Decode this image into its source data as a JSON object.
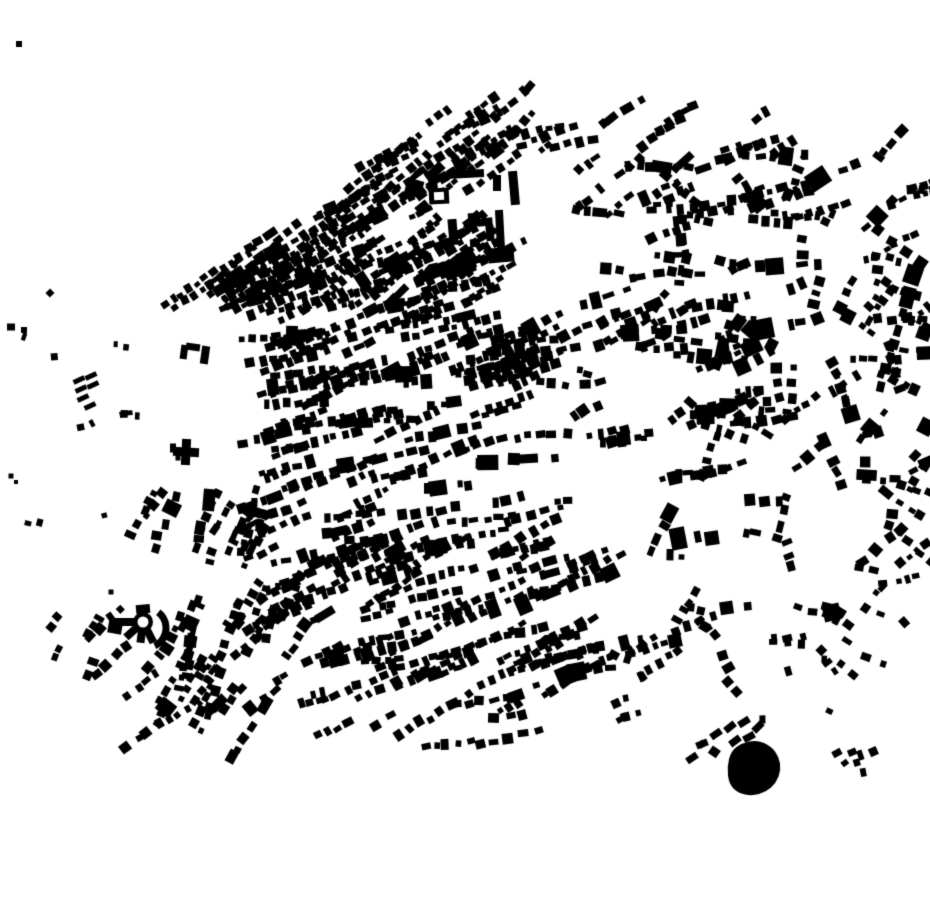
{
  "meta": {
    "map_type": "figure-ground-building-footprint-map",
    "canvas": {
      "width": 930,
      "height": 924
    }
  },
  "colors": {
    "background": "#ffffff",
    "building": "#000000"
  },
  "generation": {
    "seed": 1337,
    "regions": [
      {
        "name": "old-town-nw",
        "x": 160,
        "y": 112,
        "w": 312,
        "h": 198,
        "blocks": 100,
        "angle": -33,
        "angle_jitter": 9,
        "row_min": 3,
        "row_max": 7,
        "size_min": 4.5,
        "size_max": 10,
        "gap_min": 2,
        "gap_max": 5,
        "big_chance": 0.07,
        "rect_jitter": 7,
        "fade": "none",
        "fade_strength": 0,
        "clip_line": {
          "x1": 165,
          "y1": 298,
          "x2": 438,
          "y2": 110,
          "keep": "positive"
        },
        "avoid": []
      },
      {
        "name": "north-central",
        "x": 250,
        "y": 255,
        "w": 290,
        "h": 132,
        "blocks": 55,
        "angle": -18,
        "angle_jitter": 10,
        "row_min": 3,
        "row_max": 6,
        "size_min": 5,
        "size_max": 11,
        "gap_min": 2,
        "gap_max": 6,
        "big_chance": 0.08,
        "rect_jitter": 7,
        "fade": "none",
        "fade_strength": 0,
        "avoid": [
          {
            "x": 435,
            "y": 160,
            "w": 130,
            "h": 150
          }
        ]
      },
      {
        "name": "central-west-grid",
        "x": 225,
        "y": 335,
        "w": 292,
        "h": 228,
        "blocks": 78,
        "angle": -15,
        "angle_jitter": 12,
        "row_min": 3,
        "row_max": 6,
        "size_min": 5,
        "size_max": 11,
        "gap_min": 2,
        "gap_max": 6,
        "big_chance": 0.08,
        "rect_jitter": 7,
        "fade": "none",
        "fade_strength": 0,
        "avoid": []
      },
      {
        "name": "mid-south",
        "x": 250,
        "y": 545,
        "w": 330,
        "h": 195,
        "blocks": 56,
        "angle": -22,
        "angle_jitter": 12,
        "row_min": 3,
        "row_max": 6,
        "size_min": 5,
        "size_max": 11,
        "gap_min": 2,
        "gap_max": 6,
        "big_chance": 0.08,
        "rect_jitter": 8,
        "fade": "bottom",
        "fade_strength": 1.1,
        "avoid": []
      },
      {
        "name": "east-central",
        "x": 530,
        "y": 255,
        "w": 232,
        "h": 312,
        "blocks": 46,
        "angle": -8,
        "angle_jitter": 22,
        "row_min": 2,
        "row_max": 5,
        "size_min": 5,
        "size_max": 12,
        "gap_min": 2,
        "gap_max": 7,
        "big_chance": 0.1,
        "rect_jitter": 9,
        "fade": "none",
        "fade_strength": 0,
        "avoid": []
      },
      {
        "name": "east-scatter",
        "x": 650,
        "y": 150,
        "w": 278,
        "h": 512,
        "blocks": 62,
        "angle": 0,
        "angle_jitter": 90,
        "row_min": 2,
        "row_max": 4,
        "size_min": 5,
        "size_max": 12,
        "gap_min": 3,
        "gap_max": 8,
        "big_chance": 0.08,
        "rect_jitter": 10,
        "fade": "none",
        "fade_strength": 0,
        "avoid": []
      },
      {
        "name": "top-strip",
        "x": 450,
        "y": 108,
        "w": 372,
        "h": 132,
        "blocks": 40,
        "angle": -20,
        "angle_jitter": 26,
        "row_min": 2,
        "row_max": 5,
        "size_min": 4.5,
        "size_max": 11,
        "gap_min": 2,
        "gap_max": 7,
        "big_chance": 0.08,
        "rect_jitter": 10,
        "fade": "none",
        "fade_strength": 0,
        "avoid": [
          {
            "x": 435,
            "y": 160,
            "w": 130,
            "h": 150
          }
        ]
      },
      {
        "name": "far-right-edge",
        "x": 845,
        "y": 165,
        "w": 85,
        "h": 445,
        "blocks": 24,
        "angle": -10,
        "angle_jitter": 45,
        "row_min": 2,
        "row_max": 4,
        "size_min": 4.5,
        "size_max": 10,
        "gap_min": 2,
        "gap_max": 7,
        "big_chance": 0.06,
        "rect_jitter": 10,
        "fade": "none",
        "fade_strength": 0,
        "avoid": []
      },
      {
        "name": "southwest-band",
        "x": 148,
        "y": 488,
        "w": 135,
        "h": 222,
        "blocks": 30,
        "angle": 110,
        "angle_jitter": 13,
        "row_min": 2,
        "row_max": 5,
        "size_min": 5,
        "size_max": 11,
        "gap_min": 2,
        "gap_max": 6,
        "big_chance": 0.07,
        "rect_jitter": 9,
        "fade": "none",
        "fade_strength": 0,
        "avoid": [
          {
            "x": 100,
            "y": 595,
            "w": 80,
            "h": 60
          }
        ]
      },
      {
        "name": "bottom-left",
        "x": 35,
        "y": 615,
        "w": 272,
        "h": 178,
        "blocks": 32,
        "angle": -50,
        "angle_jitter": 16,
        "row_min": 2,
        "row_max": 4,
        "size_min": 5,
        "size_max": 11,
        "gap_min": 2,
        "gap_max": 7,
        "big_chance": 0.06,
        "rect_jitter": 10,
        "fade": "bottom",
        "fade_strength": 1.0,
        "avoid": [
          {
            "x": 100,
            "y": 595,
            "w": 80,
            "h": 60
          }
        ]
      },
      {
        "name": "bottom-center",
        "x": 300,
        "y": 640,
        "w": 342,
        "h": 152,
        "blocks": 40,
        "angle": -20,
        "angle_jitter": 16,
        "row_min": 2,
        "row_max": 5,
        "size_min": 5,
        "size_max": 11,
        "gap_min": 2,
        "gap_max": 7,
        "big_chance": 0.08,
        "rect_jitter": 12,
        "fade": "bottom",
        "fade_strength": 1.25,
        "avoid": []
      },
      {
        "name": "bottom-right",
        "x": 615,
        "y": 600,
        "w": 312,
        "h": 200,
        "blocks": 28,
        "angle": 40,
        "angle_jitter": 60,
        "row_min": 1,
        "row_max": 3,
        "size_min": 5,
        "size_max": 10,
        "gap_min": 3,
        "gap_max": 8,
        "big_chance": 0.06,
        "rect_jitter": 12,
        "fade": "bottom",
        "fade_strength": 0.7,
        "avoid": []
      },
      {
        "name": "far-left-specks",
        "x": 0,
        "y": 280,
        "w": 150,
        "h": 290,
        "blocks": 9,
        "angle": -20,
        "angle_jitter": 30,
        "row_min": 1,
        "row_max": 2,
        "size_min": 4,
        "size_max": 8,
        "gap_min": 3,
        "gap_max": 6,
        "big_chance": 0.0,
        "rect_jitter": 15,
        "fade": "none",
        "fade_strength": 0,
        "avoid": []
      }
    ]
  },
  "landmarks": {
    "large_buildings": [
      {
        "cx": 465,
        "cy": 174,
        "w": 38,
        "h": 8,
        "angle": -3
      },
      {
        "cx": 433,
        "cy": 186,
        "w": 9,
        "h": 27,
        "angle": -3
      },
      {
        "cx": 439,
        "cy": 196,
        "w": 20,
        "h": 16,
        "angle": -3,
        "hole": {
          "w": 10,
          "h": 8
        }
      },
      {
        "cx": 414,
        "cy": 188,
        "w": 17,
        "h": 17,
        "angle": 15
      },
      {
        "cx": 497,
        "cy": 183,
        "w": 8,
        "h": 16,
        "angle": 0
      },
      {
        "cx": 514,
        "cy": 188,
        "w": 9,
        "h": 34,
        "angle": -5
      },
      {
        "cx": 453,
        "cy": 232,
        "w": 9,
        "h": 26,
        "angle": -5
      },
      {
        "cx": 474,
        "cy": 218,
        "w": 12,
        "h": 10,
        "angle": -5
      },
      {
        "cx": 485,
        "cy": 222,
        "w": 15,
        "h": 8,
        "angle": -5
      },
      {
        "cx": 490,
        "cy": 233,
        "w": 8,
        "h": 16,
        "angle": -5
      },
      {
        "cx": 475,
        "cy": 243,
        "w": 10,
        "h": 8,
        "angle": -5
      },
      {
        "cx": 500,
        "cy": 230,
        "w": 8,
        "h": 40,
        "angle": -3
      },
      {
        "cx": 501,
        "cy": 255,
        "w": 26,
        "h": 15,
        "angle": -5
      },
      {
        "cx": 395,
        "cy": 306,
        "w": 17,
        "h": 13,
        "angle": -10
      },
      {
        "cx": 205,
        "cy": 355,
        "w": 8,
        "h": 18,
        "angle": 8
      },
      {
        "cx": 193,
        "cy": 347,
        "w": 14,
        "h": 7,
        "angle": 8
      },
      {
        "cx": 184,
        "cy": 352,
        "w": 7,
        "h": 14,
        "angle": 8
      },
      {
        "cx": 209,
        "cy": 500,
        "w": 12,
        "h": 22,
        "angle": 5
      },
      {
        "cx": 200,
        "cy": 528,
        "w": 10,
        "h": 14,
        "angle": 10
      },
      {
        "cx": 115,
        "cy": 628,
        "w": 14,
        "h": 11,
        "angle": 10
      },
      {
        "cx": 19,
        "cy": 44,
        "w": 6,
        "h": 6,
        "angle": 0
      },
      {
        "cx": 11,
        "cy": 327,
        "w": 8,
        "h": 7,
        "angle": 0
      },
      {
        "cx": 24,
        "cy": 330,
        "w": 6,
        "h": 6,
        "angle": 0
      },
      {
        "cx": 11,
        "cy": 476,
        "w": 5,
        "h": 5,
        "angle": 0
      },
      {
        "cx": 16,
        "cy": 482,
        "w": 4,
        "h": 4,
        "angle": 0
      },
      {
        "cx": 111,
        "cy": 592,
        "w": 5,
        "h": 5,
        "angle": 0
      },
      {
        "cx": 173,
        "cy": 448,
        "w": 6,
        "h": 9,
        "angle": 0
      },
      {
        "cx": 178,
        "cy": 458,
        "w": 5,
        "h": 5,
        "angle": 0
      }
    ],
    "bar_cluster": {
      "angle": -25,
      "bar_w": 12,
      "bar_h": 5,
      "positions": [
        [
          79,
          380
        ],
        [
          91,
          376
        ],
        [
          81,
          389
        ],
        [
          93,
          385
        ],
        [
          83,
          398
        ],
        [
          90,
          406
        ]
      ]
    },
    "cross_building": {
      "cx": 186,
      "cy": 452,
      "arm_len": 26,
      "arm_w": 9,
      "angle": 3
    },
    "radial_building": {
      "cx": 143,
      "cy": 622,
      "outer_r": 10,
      "inner_r": 5.5,
      "arms": [
        {
          "angle": 180,
          "len": 34,
          "w": 8
        },
        {
          "angle": 138,
          "len": 23,
          "w": 8
        },
        {
          "angle": 97,
          "len": 21,
          "w": 8
        },
        {
          "angle": 63,
          "len": 23,
          "w": 8
        }
      ],
      "top_block": {
        "cx": 143,
        "cy": 609,
        "w": 14,
        "h": 9,
        "angle": -5
      },
      "arc": {
        "cx": 146,
        "cy": 628,
        "r": 20,
        "start_deg": -52,
        "end_deg": 64,
        "width": 7
      }
    },
    "pond": {
      "points": [
        [
          727,
          767
        ],
        [
          731,
          751
        ],
        [
          742,
          743
        ],
        [
          757,
          740
        ],
        [
          771,
          746
        ],
        [
          779,
          757
        ],
        [
          781,
          770
        ],
        [
          776,
          783
        ],
        [
          766,
          792
        ],
        [
          752,
          796
        ],
        [
          738,
          793
        ],
        [
          729,
          784
        ]
      ]
    },
    "pond_ring_buildings": {
      "angle": -35,
      "bar_w": 12,
      "bar_h": 7,
      "positions": [
        [
          716,
          734
        ],
        [
          730,
          727
        ],
        [
          744,
          722
        ],
        [
          758,
          727
        ],
        [
          735,
          741
        ],
        [
          749,
          737
        ],
        [
          702,
          744
        ],
        [
          692,
          758
        ]
      ]
    }
  }
}
